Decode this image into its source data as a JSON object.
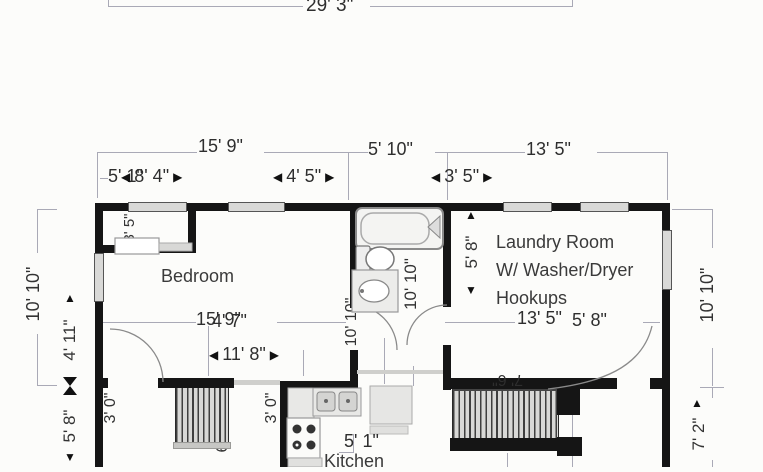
{
  "title": "floor-plan",
  "colors": {
    "wall": "#151515",
    "dim_line": "#a9a9b6",
    "text": "#2e2e2e"
  },
  "icons": {
    "arrow_left": "◀",
    "arrow_right": "▶",
    "arrow_up": "▲",
    "arrow_down": "▼"
  },
  "rooms": {
    "bedroom": "Bedroom",
    "kitchen": "Kitchen",
    "laundry_lines": [
      "Laundry Room",
      "W/ Washer/Dryer",
      "Hookups"
    ]
  },
  "dimensions": {
    "overall_width": "29' 3\"",
    "bedroom_top": "15' 9\"",
    "bath_top": "5' 10\"",
    "laundry_top": "13' 5\"",
    "bedroom_sub_hidden": "5' 1\"",
    "bedroom_sub": "8' 4\"",
    "bedroom_window": "4' 5\"",
    "laundry_sub": "3' 5\"",
    "closet_depth": "3' 5\"",
    "bedroom_mid": "15' 9\"",
    "bedroom_mid_sub": "4' 7\"",
    "bedroom_lower": "11' 8\"",
    "laundry_low": "13' 5\"",
    "laundry_low_sub": "5' 8\"",
    "left_upper": "10' 10\"",
    "left_inner_upper": "4' 11\"",
    "left_inner_lower": "5' 8\"",
    "hall_a": "3' 0\"",
    "hall_b": "3' 0\"",
    "bath_depth": "10' 10\"",
    "bath_depth_partial": "10' 10\"",
    "laundry_height": "5' 8\"",
    "right_upper": "10' 10\"",
    "right_lower": "7' 2\"",
    "stairs_top": "7' 6\"",
    "stairs_left": "6' 2\"",
    "kitchen_width": "5' 1\""
  }
}
